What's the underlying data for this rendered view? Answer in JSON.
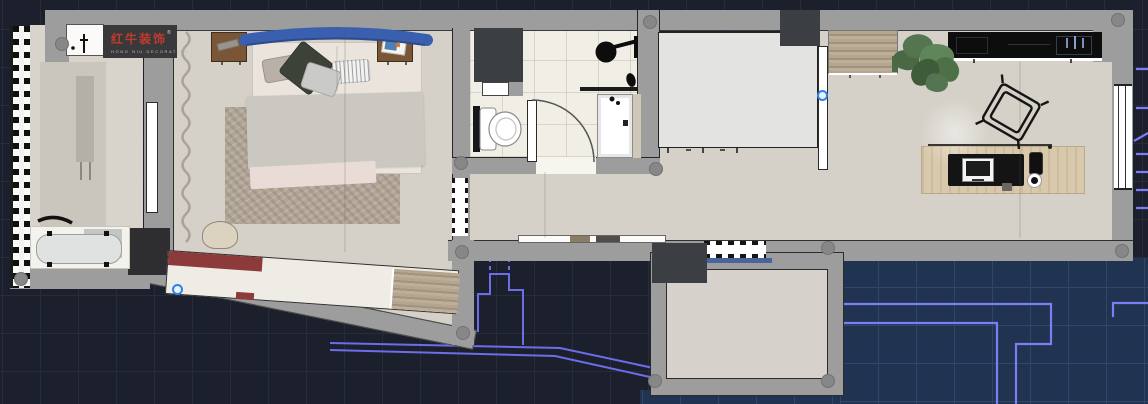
{
  "window": {
    "app": "cad-floorplan-viewport",
    "width": 1148,
    "height": 404
  },
  "logo": {
    "brand": "红牛装饰",
    "registered": "®",
    "tagline": "HONG NIU DECORATION"
  },
  "colors": {
    "bg_dark": "#1b202c",
    "grid_dark": "#262c39",
    "bg_blue": "#203350",
    "grid_blue": "#2c4868",
    "cad_line": "#6c6de8",
    "cad_line_bright": "#7d7ef5",
    "wall": "#9d9d9d",
    "wall_shadow": "#878787",
    "wall_dark": "#3b3e42",
    "outline": "#2a2a2a",
    "floor": "#d5d1c9",
    "floor_bath": "#f1eee6",
    "floor_balcony": "#d8d4cb",
    "floor_platform": "#e3e3e1",
    "floor_lower": "#d6d1ca",
    "rug": "#b2a698",
    "wood_dark": "#7a5536",
    "wood_light": "#d9c9ac",
    "wood_mid": "#b3a58f",
    "red_accent": "#8d3a3b",
    "logo_bg": "#39393b",
    "logo_red": "#c23a2c",
    "headboard": "#3a5fae",
    "grip": "#2f82ea",
    "sill_blue": "#47659a",
    "plant": "#557550",
    "counter_black": "#0d0d0d"
  },
  "scene": {
    "rooms": [
      "balcony-laundry",
      "master-bedroom",
      "bathroom",
      "hallway",
      "study-living",
      "kitchen-bar",
      "lower-balcony"
    ],
    "furniture": [
      "washing-machine",
      "bathtub",
      "drying-rack",
      "double-bed",
      "nightstand",
      "nightstand",
      "area-rug",
      "accent-chair",
      "tilted-wardrobe",
      "toilet",
      "shower-head",
      "shower-tray",
      "bathroom-door",
      "platform-bed",
      "open-door",
      "wood-cabinet",
      "potted-plant",
      "kitchen-counter",
      "desk",
      "desk-chair",
      "monitor",
      "tablet",
      "coffee-cup",
      "shoe-cabinet"
    ],
    "cad_marks": {
      "grip_points": 2,
      "column_dots": 12
    }
  }
}
